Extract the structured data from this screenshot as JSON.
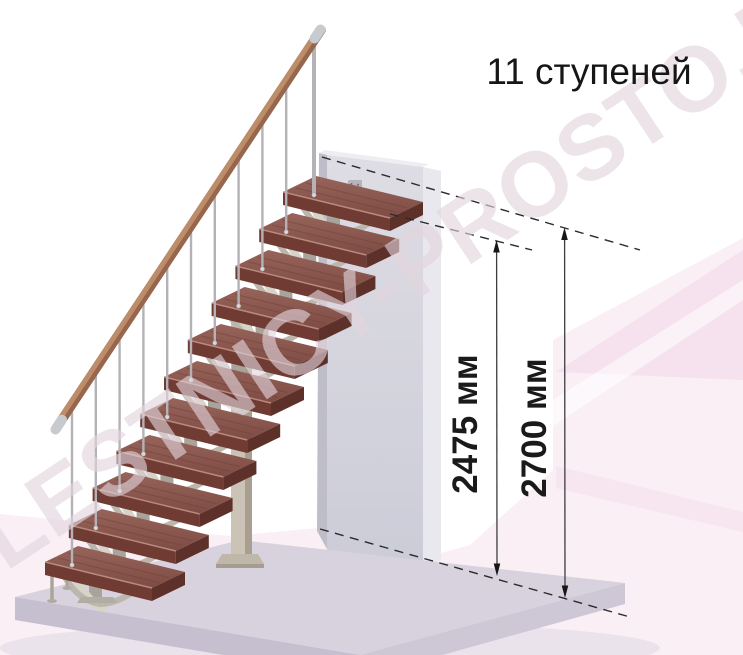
{
  "title": "11 ступеней",
  "watermark": "LESTNICY-PROSTO.RU",
  "dimensions": {
    "to_top_step": "2475 мм",
    "to_floor_level": "2700 мм"
  },
  "colors": {
    "tread_top": "#8d5a51",
    "tread_front": "#6f3b33",
    "handrail": "#ab7a5f",
    "metal_support": "#b0aba1",
    "baluster": "#b4b2b6",
    "wall": "#d8d7df",
    "floor_slab": "#d8d2de",
    "background_tint": "#f8ecf4",
    "text": "#1a1a1a"
  }
}
